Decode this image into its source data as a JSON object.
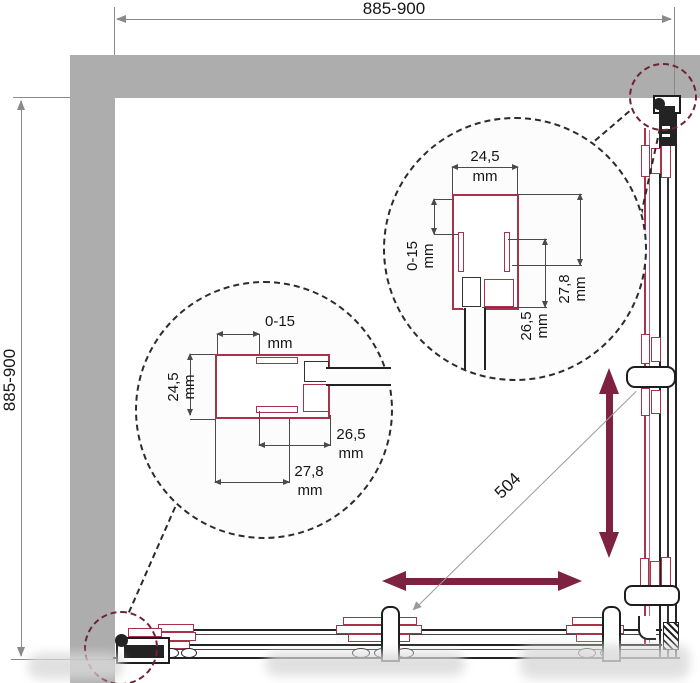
{
  "drawing": {
    "dim_top": {
      "value": "885-900"
    },
    "dim_left": {
      "value": "885-900"
    },
    "dim_diagonal": {
      "value": "504"
    },
    "detail_right": {
      "top_width": {
        "value": "24,5",
        "unit": "mm"
      },
      "wall_adjust": {
        "value": "0-15",
        "unit": "mm"
      },
      "depth": {
        "value": "27,8",
        "unit": "mm"
      },
      "inner_depth": {
        "value": "26,5",
        "unit": "mm"
      }
    },
    "detail_left": {
      "wall_adjust": {
        "value": "0-15",
        "unit": "mm"
      },
      "top_width": {
        "value": "24,5",
        "unit": "mm"
      },
      "inner_depth": {
        "value": "26,5",
        "unit": "mm"
      },
      "depth": {
        "value": "27,8",
        "unit": "mm"
      }
    },
    "colors": {
      "wall_gray": "#adadad",
      "arrow_maroon": "#7d2240",
      "profile_red": "#a8324a",
      "dim_gray": "#8a8a8a",
      "callout_maroon": "#6d2235"
    }
  }
}
